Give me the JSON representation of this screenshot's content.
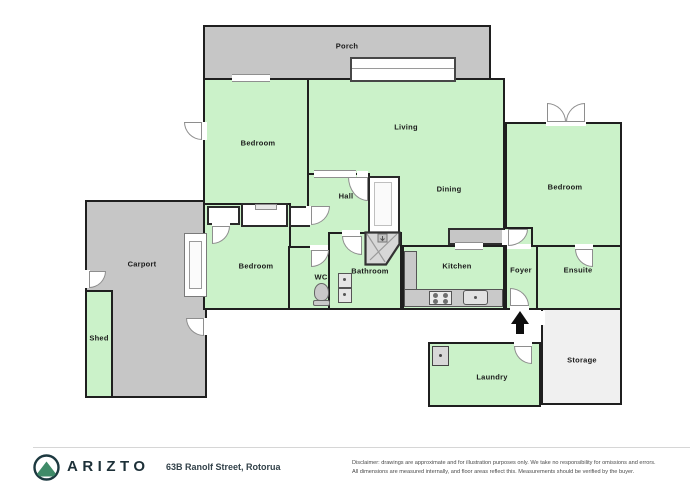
{
  "floor_plan": {
    "rooms": [
      {
        "id": "porch",
        "label": "Porch"
      },
      {
        "id": "bedroom-top-left",
        "label": "Bedroom"
      },
      {
        "id": "living",
        "label": "Living"
      },
      {
        "id": "dining",
        "label": "Dining"
      },
      {
        "id": "hall",
        "label": "Hall"
      },
      {
        "id": "bedroom-middle-left",
        "label": "Bedroom"
      },
      {
        "id": "wc",
        "label": "WC"
      },
      {
        "id": "bathroom",
        "label": "Bathroom"
      },
      {
        "id": "kitchen",
        "label": "Kitchen"
      },
      {
        "id": "foyer",
        "label": "Foyer"
      },
      {
        "id": "ensuite",
        "label": "Ensuite"
      },
      {
        "id": "bedroom-right",
        "label": "Bedroom"
      },
      {
        "id": "carport",
        "label": "Carport"
      },
      {
        "id": "shed",
        "label": "Shed"
      },
      {
        "id": "laundry",
        "label": "Laundry"
      },
      {
        "id": "storage",
        "label": "Storage"
      }
    ],
    "fixtures": [
      "sliding-door",
      "french-doors",
      "corner-shower",
      "toilet",
      "vanity",
      "cooktop",
      "kitchen-sink",
      "laundry-tub",
      "entrance-arrow",
      "wardrobes",
      "tall-cupboard",
      "kitchen-bench",
      "carport-window"
    ],
    "colors": {
      "room_fill": "#cbf2c9",
      "outdoor_fill": "#c6c6c6",
      "storage_fill": "#f0f0f0",
      "wall": "#1f1f1f",
      "brand_dark": "#1d3038",
      "brand_green": "#3f8a68"
    }
  },
  "footer": {
    "brand": "ARIZTO",
    "address": "63B Ranolf Street, Rotorua",
    "disclaimer_line1": "Disclaimer: drawings are approximate and for illustration purposes only. We take no responsibility for omissions and errors.",
    "disclaimer_line2": "All dimensions are measured internally, and floor areas reflect this. Measurements should be verified by the buyer."
  }
}
